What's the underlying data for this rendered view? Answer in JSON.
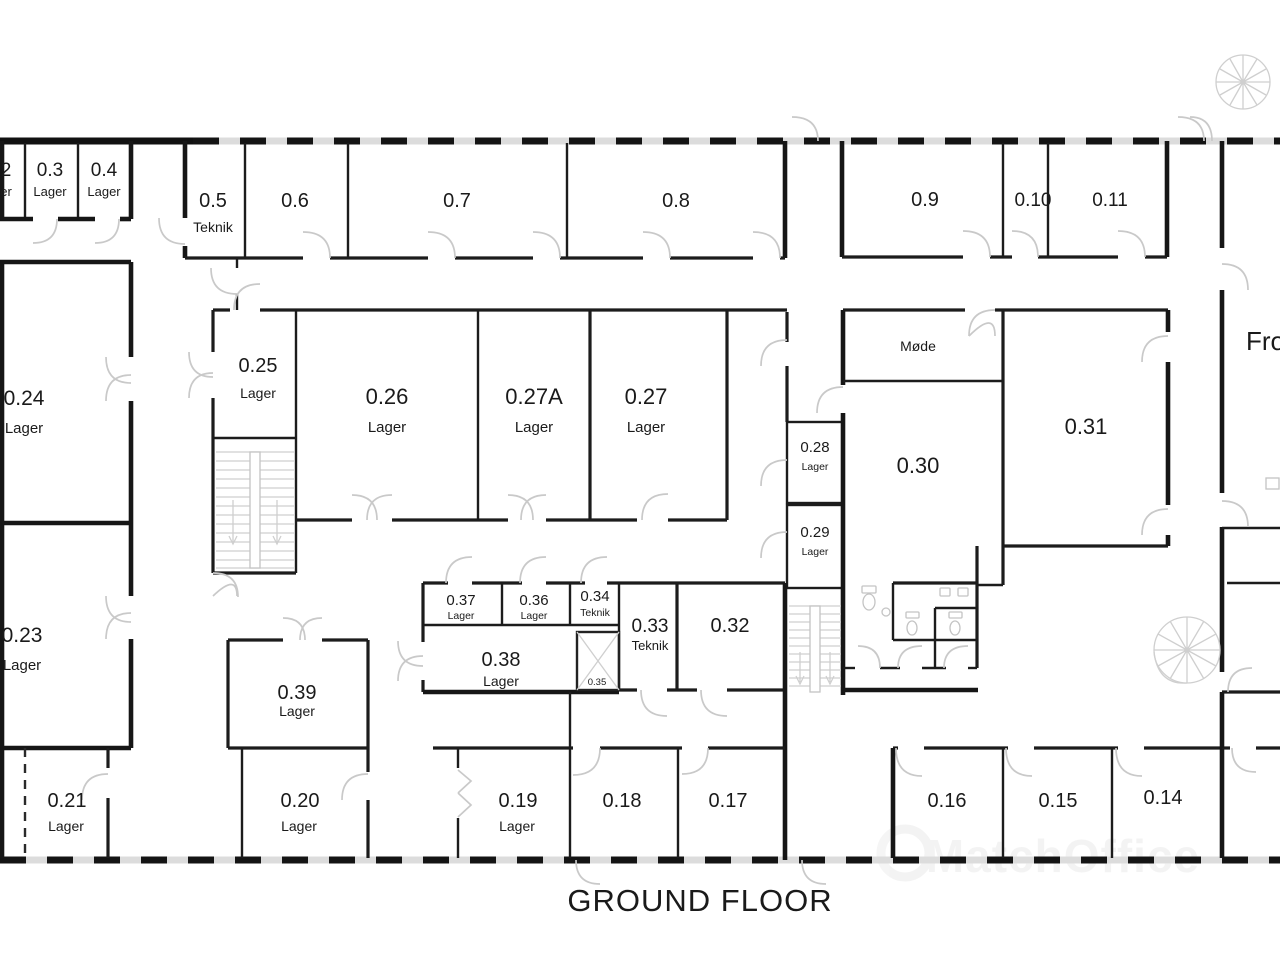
{
  "title": "GROUND FLOOR",
  "watermark": "MatchOffice",
  "colors": {
    "wall": "#1c1c1c",
    "door_arc": "#c9c9c9",
    "window_band": "#dcdcdc",
    "text": "#1a1a1a"
  },
  "rooms": {
    "r02": {
      "number": "2",
      "type": "er"
    },
    "r03": {
      "number": "0.3",
      "type": "Lager"
    },
    "r04": {
      "number": "0.4",
      "type": "Lager"
    },
    "r05": {
      "number": "0.5",
      "type": "Teknik"
    },
    "r06": {
      "number": "0.6"
    },
    "r07": {
      "number": "0.7"
    },
    "r08": {
      "number": "0.8"
    },
    "r09": {
      "number": "0.9"
    },
    "r10": {
      "number": "0.10"
    },
    "r11": {
      "number": "0.11"
    },
    "r14": {
      "number": "0.14"
    },
    "r15": {
      "number": "0.15"
    },
    "r16": {
      "number": "0.16"
    },
    "r17": {
      "number": "0.17"
    },
    "r18": {
      "number": "0.18"
    },
    "r19": {
      "number": "0.19",
      "type": "Lager"
    },
    "r20": {
      "number": "0.20",
      "type": "Lager"
    },
    "r21": {
      "number": "0.21",
      "type": "Lager"
    },
    "r23": {
      "number": "0.23",
      "type": "Lager"
    },
    "r24": {
      "number": "0.24",
      "type": "Lager"
    },
    "r25": {
      "number": "0.25",
      "type": "Lager"
    },
    "r26": {
      "number": "0.26",
      "type": "Lager"
    },
    "r27A": {
      "number": "0.27A",
      "type": "Lager"
    },
    "r27": {
      "number": "0.27",
      "type": "Lager"
    },
    "r28": {
      "number": "0.28",
      "type": "Lager"
    },
    "r29": {
      "number": "0.29",
      "type": "Lager"
    },
    "r30": {
      "number": "0.30"
    },
    "r31": {
      "number": "0.31"
    },
    "r32": {
      "number": "0.32"
    },
    "r33": {
      "number": "0.33",
      "type": "Teknik"
    },
    "r34": {
      "number": "0.34",
      "type": "Teknik"
    },
    "r35": {
      "number": "0.35"
    },
    "r36": {
      "number": "0.36",
      "type": "Lager"
    },
    "r37": {
      "number": "0.37",
      "type": "Lager"
    },
    "r38": {
      "number": "0.38",
      "type": "Lager"
    },
    "r39": {
      "number": "0.39",
      "type": "Lager"
    },
    "mode": {
      "name": "Møde"
    },
    "frokost": {
      "name": "Frok"
    }
  }
}
